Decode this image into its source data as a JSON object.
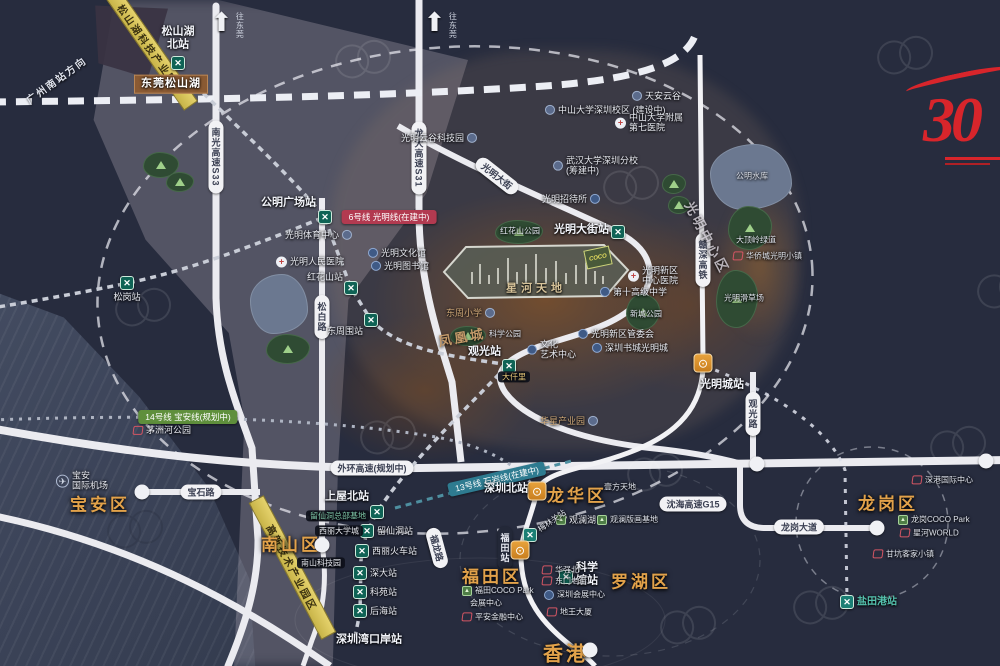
{
  "colors": {
    "bg": "#272c3e",
    "sea": "#3c4459",
    "road": "#ebebf0",
    "district_text": "#e2a24a",
    "metro_icon": "#0f6355",
    "rail_icon": "#e8a23c",
    "line6_badge": "#b23a50",
    "line14_badge": "#5f8f3c",
    "line13_badge": "#2e7b90",
    "logo_red": "#d8252b",
    "industry_band": "#d9c75a"
  },
  "project": {
    "name": "星河天地"
  },
  "logo": {
    "text": "30"
  },
  "arrows": [
    {
      "t": "往东莞",
      "x": 228,
      "y": 12
    },
    {
      "t": "往东莞",
      "x": 441,
      "y": 12
    }
  ],
  "rail_direction": {
    "t": "广州南站方向",
    "x": 20,
    "y": 72,
    "rot": -36
  },
  "coco_box": {
    "t": "COCO",
    "x": 597,
    "y": 257
  },
  "bands": [
    {
      "t": "松山湖科技产业园",
      "x": 148,
      "y": 45,
      "rot": 55,
      "w": 150
    },
    {
      "t": "高新技术产业园区",
      "x": 292,
      "y": 568,
      "rot": 62,
      "w": 155
    }
  ],
  "line_badges": [
    {
      "t": "6号线 光明线(在建中)",
      "x": 389,
      "y": 217,
      "style": "red",
      "rot": 0
    },
    {
      "t": "14号线 宝安线(规划中)",
      "x": 188,
      "y": 417,
      "style": "green",
      "rot": 0
    },
    {
      "t": "13号线 石岩线(在建中)",
      "x": 497,
      "y": 479,
      "style": "teal",
      "rot": -13
    }
  ],
  "road_pills": [
    {
      "t": "南光高速S33",
      "x": 216,
      "y": 157,
      "vert": true
    },
    {
      "t": "龙大高速S31",
      "x": 419,
      "y": 158,
      "vert": true
    },
    {
      "t": "松白路",
      "x": 322,
      "y": 317,
      "vert": true
    },
    {
      "t": "观光路",
      "x": 753,
      "y": 414,
      "vert": true
    },
    {
      "t": "赣深高铁",
      "x": 703,
      "y": 260,
      "vert": true
    },
    {
      "t": "宝石路",
      "x": 201,
      "y": 492
    },
    {
      "t": "沈海高速G15",
      "x": 693,
      "y": 504
    },
    {
      "t": "龙岗大道",
      "x": 799,
      "y": 527
    },
    {
      "t": "外环高速(规划中)",
      "x": 372,
      "y": 468
    },
    {
      "t": "光明大街",
      "x": 497,
      "y": 176,
      "rot": 38
    },
    {
      "t": "福龙路",
      "x": 437,
      "y": 548,
      "rot": 75
    },
    {
      "t": "福田站",
      "x": 505,
      "y": 548,
      "vert": true,
      "dark": true
    }
  ],
  "districts": [
    {
      "t": "宝安区",
      "x": 100,
      "y": 503
    },
    {
      "t": "南山区",
      "x": 291,
      "y": 543
    },
    {
      "t": "福田区",
      "x": 492,
      "y": 575
    },
    {
      "t": "龙华区",
      "x": 577,
      "y": 494
    },
    {
      "t": "罗湖区",
      "x": 641,
      "y": 580
    },
    {
      "t": "龙岗区",
      "x": 888,
      "y": 502
    },
    {
      "t": "香港",
      "x": 566,
      "y": 652,
      "fs": 20
    }
  ],
  "zone_texts": [
    {
      "t": "光明中心区",
      "x": 668,
      "y": 228,
      "rot": 62,
      "cls": ""
    },
    {
      "t": "凤凰城",
      "x": 438,
      "y": 327,
      "rot": -10,
      "cls": "tanz"
    }
  ],
  "metro_stations": [
    {
      "t": "松山湖\n北站",
      "x": 178,
      "y": 63,
      "lx": 178,
      "ly": 38,
      "a": "c",
      "big": true
    },
    {
      "t": "公明广场站",
      "x": 325,
      "y": 217,
      "lx": 316,
      "ly": 203,
      "a": "r",
      "big": true
    },
    {
      "t": "松岗站",
      "x": 127,
      "y": 283,
      "lx": 127,
      "ly": 297,
      "a": "c"
    },
    {
      "t": "红花山站",
      "x": 351,
      "y": 288,
      "lx": 343,
      "ly": 277,
      "a": "r"
    },
    {
      "t": "东周围站",
      "x": 371,
      "y": 320,
      "lx": 363,
      "ly": 331,
      "a": "r"
    },
    {
      "t": "观光站",
      "x": 509,
      "y": 366,
      "lx": 501,
      "ly": 352,
      "a": "r",
      "big": true
    },
    {
      "t": "光明大街站",
      "x": 618,
      "y": 232,
      "lx": 609,
      "ly": 230,
      "a": "r",
      "big": true
    },
    {
      "t": "上屋北站",
      "x": 377,
      "y": 512,
      "lx": 369,
      "ly": 497,
      "a": "r",
      "big": true
    },
    {
      "t": "留仙洞站",
      "x": 367,
      "y": 531,
      "lx": 377,
      "ly": 531,
      "a": "l"
    },
    {
      "t": "西丽火车站",
      "x": 362,
      "y": 551,
      "lx": 372,
      "ly": 551,
      "a": "l"
    },
    {
      "t": "深大站",
      "x": 360,
      "y": 573,
      "lx": 370,
      "ly": 573,
      "a": "l"
    },
    {
      "t": "科苑站",
      "x": 360,
      "y": 592,
      "lx": 370,
      "ly": 592,
      "a": "l"
    },
    {
      "t": "后海站",
      "x": 360,
      "y": 611,
      "lx": 370,
      "ly": 611,
      "a": "l"
    },
    {
      "t": "科学\n馆站",
      "x": 566,
      "y": 577,
      "lx": 576,
      "ly": 574,
      "a": "l",
      "big": true
    },
    {
      "t": "盐田港站",
      "x": 847,
      "y": 602,
      "lx": 857,
      "ly": 602,
      "a": "l",
      "teal": true,
      "tealtx": true
    },
    {
      "t": "",
      "x": 530,
      "y": 535,
      "lx": 0,
      "ly": 0,
      "a": "l",
      "teal": true
    }
  ],
  "rail_stations": [
    {
      "t": "光明城站",
      "x": 703,
      "y": 363,
      "lx": 700,
      "ly": 385,
      "a": "l"
    },
    {
      "t": "深圳北站",
      "x": 537,
      "y": 491,
      "lx": 528,
      "ly": 489,
      "a": "r"
    },
    {
      "t": "",
      "x": 520,
      "y": 550,
      "lx": 0,
      "ly": 0,
      "a": "l"
    }
  ],
  "hk_node": {
    "x": 590,
    "y": 650
  },
  "ring_nodes": [
    [
      142,
      492
    ],
    [
      322,
      545
    ],
    [
      877,
      528
    ],
    [
      757,
      464
    ],
    [
      986,
      461
    ]
  ],
  "pois": [
    {
      "t": "天安云谷",
      "x": 632,
      "y": 96,
      "ic": "circle"
    },
    {
      "t": "中山大学深圳校区 (建设中)",
      "x": 545,
      "y": 110,
      "ic": "circle"
    },
    {
      "t": "中山大学附属\n第七医院",
      "x": 615,
      "y": 123,
      "ic": "cross"
    },
    {
      "t": "光明云谷科技园",
      "x": 477,
      "y": 138,
      "ic": "circle",
      "ip": "r"
    },
    {
      "t": "武汉大学深圳分校\n(筹建中)",
      "x": 553,
      "y": 166,
      "ic": "circle"
    },
    {
      "t": "光明招待所",
      "x": 600,
      "y": 199,
      "ic": "blue",
      "ip": "r"
    },
    {
      "t": "光明体育中心",
      "x": 352,
      "y": 235,
      "ic": "circle",
      "ip": "r"
    },
    {
      "t": "光明文化馆",
      "x": 368,
      "y": 253,
      "ic": "blue"
    },
    {
      "t": "光明图书馆",
      "x": 371,
      "y": 266,
      "ic": "blue"
    },
    {
      "t": "光明人民医院",
      "x": 276,
      "y": 262,
      "ic": "cross"
    },
    {
      "t": "公明水库",
      "x": 736,
      "y": 176,
      "cls": "tiny"
    },
    {
      "t": "华侨城光明小镇",
      "x": 733,
      "y": 256,
      "ic": "red",
      "cls": "tiny"
    },
    {
      "t": "光明新区\n中心医院",
      "x": 628,
      "y": 276,
      "ic": "cross"
    },
    {
      "t": "第十高级中学",
      "x": 600,
      "y": 292,
      "ic": "blue"
    },
    {
      "t": "东周小学",
      "x": 495,
      "y": 313,
      "ic": "circle",
      "ip": "r",
      "cls": "tan"
    },
    {
      "t": "光明新区管委会",
      "x": 578,
      "y": 334,
      "ic": "blue"
    },
    {
      "t": "文化\n艺术中心",
      "x": 527,
      "y": 350,
      "ic": "blue"
    },
    {
      "t": "深圳书城光明城",
      "x": 592,
      "y": 348,
      "ic": "blue"
    },
    {
      "t": "华星产业园",
      "x": 598,
      "y": 421,
      "ic": "circle",
      "ip": "r",
      "cls": "tan"
    },
    {
      "t": "宝安\n国际机场",
      "x": 56,
      "y": 481,
      "ic": "plane"
    },
    {
      "t": "茅洲河公园",
      "x": 133,
      "y": 430,
      "ic": "red"
    },
    {
      "t": "留仙洞总部基地",
      "x": 306,
      "y": 516,
      "cls": "pill-dark green-text"
    },
    {
      "t": "西丽大学城",
      "x": 315,
      "y": 531,
      "cls": "pill-dark"
    },
    {
      "t": "南山科技园",
      "x": 297,
      "y": 563,
      "cls": "pill-dark"
    },
    {
      "t": "壹方天地",
      "x": 604,
      "y": 487,
      "cls": "tiny"
    },
    {
      "t": "观澜湖",
      "x": 556,
      "y": 520,
      "ic": "green"
    },
    {
      "t": "观澜版画基地",
      "x": 597,
      "y": 520,
      "ic": "green",
      "cls": "tiny"
    },
    {
      "t": "梅林关站",
      "x": 536,
      "y": 521,
      "cls": "tiny",
      "rot": -35
    },
    {
      "t": "华强北",
      "x": 542,
      "y": 570,
      "ic": "red",
      "cls": "tiny"
    },
    {
      "t": "东门老街",
      "x": 542,
      "y": 581,
      "ic": "red",
      "cls": "tiny"
    },
    {
      "t": "深圳会展中心",
      "x": 544,
      "y": 595,
      "ic": "blue",
      "cls": "tiny"
    },
    {
      "t": "地王大厦",
      "x": 547,
      "y": 612,
      "ic": "red",
      "cls": "tiny"
    },
    {
      "t": "福田COCO Park",
      "x": 462,
      "y": 591,
      "ic": "green",
      "cls": "tiny"
    },
    {
      "t": "会展中心",
      "x": 470,
      "y": 603,
      "cls": "tiny"
    },
    {
      "t": "平安金融中心",
      "x": 462,
      "y": 617,
      "ic": "red",
      "cls": "tiny"
    },
    {
      "t": "深港国际中心",
      "x": 912,
      "y": 480,
      "ic": "red",
      "cls": "tiny"
    },
    {
      "t": "龙岗COCO Park",
      "x": 898,
      "y": 520,
      "ic": "green",
      "cls": "tiny"
    },
    {
      "t": "星河WORLD",
      "x": 900,
      "y": 533,
      "ic": "red",
      "cls": "tiny"
    },
    {
      "t": "甘坑客家小镇",
      "x": 873,
      "y": 554,
      "ic": "red",
      "cls": "tiny"
    },
    {
      "t": "大仟里",
      "x": 498,
      "y": 377,
      "cls": "pill-dark gold-text"
    },
    {
      "t": "深圳湾口岸站",
      "x": 336,
      "y": 640,
      "cls": "stn"
    },
    {
      "t": "东莞松山湖",
      "x": 134,
      "y": 84,
      "cls": "box-brown"
    },
    {
      "t": "科学公园",
      "x": 489,
      "y": 334,
      "cls": "tiny"
    },
    {
      "t": "红花山公园",
      "x": 500,
      "y": 231,
      "cls": "tiny"
    },
    {
      "t": "大顶岭绿道",
      "x": 736,
      "y": 240,
      "cls": "tiny"
    },
    {
      "t": "光明滑草场",
      "x": 724,
      "y": 298,
      "cls": "tiny"
    },
    {
      "t": "新城公园",
      "x": 630,
      "y": 314,
      "cls": "tiny"
    }
  ],
  "parks": [
    {
      "x": 143,
      "y": 152,
      "w": 36,
      "h": 26
    },
    {
      "x": 166,
      "y": 172,
      "w": 28,
      "h": 20
    },
    {
      "x": 495,
      "y": 220,
      "w": 48,
      "h": 24
    },
    {
      "x": 450,
      "y": 326,
      "w": 36,
      "h": 20
    },
    {
      "x": 626,
      "y": 294,
      "w": 34,
      "h": 36
    },
    {
      "x": 662,
      "y": 174,
      "w": 24,
      "h": 20
    },
    {
      "x": 668,
      "y": 196,
      "w": 22,
      "h": 18
    },
    {
      "x": 728,
      "y": 206,
      "w": 44,
      "h": 44
    },
    {
      "x": 716,
      "y": 270,
      "w": 42,
      "h": 58
    },
    {
      "x": 266,
      "y": 334,
      "w": 44,
      "h": 30
    }
  ],
  "lakes": [
    {
      "x": 250,
      "y": 274,
      "w": 58,
      "h": 60
    },
    {
      "x": 710,
      "y": 144,
      "w": 82,
      "h": 66
    }
  ],
  "watermarks": [
    [
      110,
      300
    ],
    [
      355,
      428
    ],
    [
      622,
      465
    ],
    [
      598,
      178
    ],
    [
      872,
      48
    ],
    [
      925,
      438
    ],
    [
      102,
      522
    ],
    [
      655,
      618
    ],
    [
      972,
      282
    ],
    [
      330,
      52
    ],
    [
      788,
      598
    ]
  ]
}
